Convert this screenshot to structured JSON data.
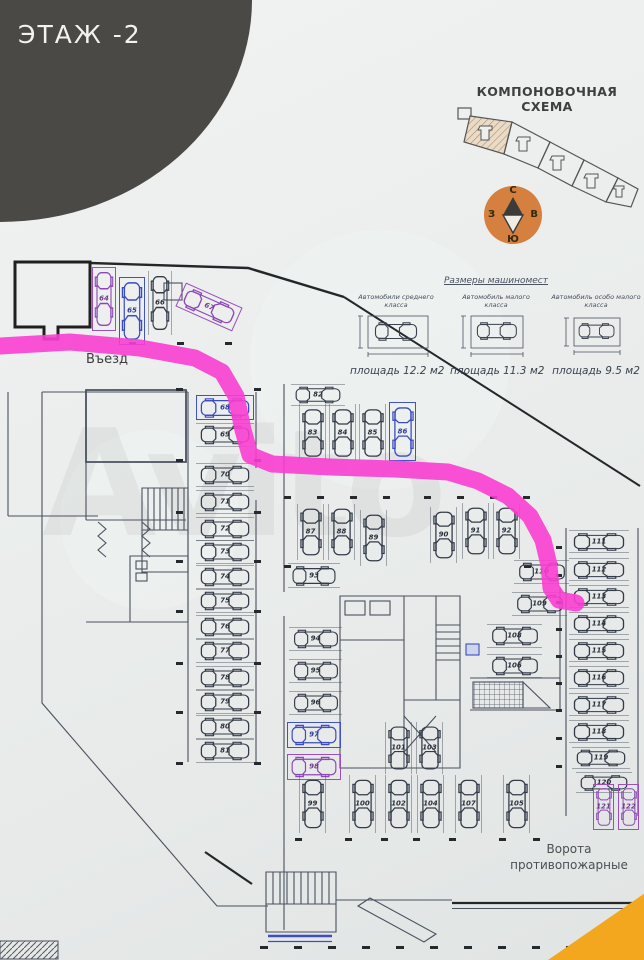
{
  "page": {
    "title": "ЭТАЖ -2",
    "background": "#e9ecea"
  },
  "scheme": {
    "title": "КОМПОНОВОЧНАЯ СХЕМА"
  },
  "compass": {
    "north": "С",
    "east": "В",
    "south": "Ю",
    "west": "З",
    "circle_color": "#d5803e"
  },
  "sizes": {
    "title": "Размеры машиномест",
    "items": [
      {
        "car_class": "Автомобили среднего класса",
        "area": "площадь 12.2 м2"
      },
      {
        "car_class": "Автомобиль малого класса",
        "area": "площадь 11.3 м2"
      },
      {
        "car_class": "Автомобиль особо малого класса",
        "area": "площадь 9.5 м2"
      }
    ]
  },
  "plan": {
    "entrance_label": "Въезд",
    "gates_label": "Ворота противопожарные",
    "route_color": "#fa3ed2",
    "highlight_blue": "#4152c2",
    "highlight_purple": "#9a4fc0",
    "route_points": [
      [
        0,
        346
      ],
      [
        70,
        342
      ],
      [
        140,
        348
      ],
      [
        195,
        358
      ],
      [
        222,
        372
      ],
      [
        236,
        396
      ],
      [
        243,
        430
      ],
      [
        250,
        455
      ],
      [
        272,
        464
      ],
      [
        330,
        467
      ],
      [
        395,
        469
      ],
      [
        448,
        472
      ],
      [
        478,
        481
      ],
      [
        508,
        496
      ],
      [
        530,
        516
      ],
      [
        543,
        540
      ],
      [
        549,
        565
      ],
      [
        551,
        588
      ],
      [
        559,
        600
      ],
      [
        576,
        603
      ]
    ],
    "stalls": [
      {
        "n": "64",
        "x": 92,
        "y": 267,
        "w": 24,
        "h": 64,
        "o": "v",
        "hl": "purple"
      },
      {
        "n": "65",
        "x": 119,
        "y": 277,
        "w": 26,
        "h": 68,
        "o": "v",
        "hl": "blue"
      },
      {
        "n": "66",
        "x": 148,
        "y": 271,
        "w": 24,
        "h": 64,
        "o": "v"
      },
      {
        "n": "67",
        "x": 178,
        "y": 294,
        "w": 62,
        "h": 26,
        "o": "h",
        "hl": "purple",
        "a": 24
      },
      {
        "n": "68",
        "x": 196,
        "y": 395,
        "w": 58,
        "h": 25,
        "o": "h",
        "hl": "blue"
      },
      {
        "n": "69",
        "x": 196,
        "y": 423,
        "w": 58,
        "h": 24,
        "o": "h"
      },
      {
        "n": "70",
        "x": 196,
        "y": 463,
        "w": 58,
        "h": 24,
        "o": "h"
      },
      {
        "n": "71",
        "x": 196,
        "y": 490,
        "w": 58,
        "h": 24,
        "o": "h"
      },
      {
        "n": "72",
        "x": 196,
        "y": 517,
        "w": 58,
        "h": 24,
        "o": "h"
      },
      {
        "n": "73",
        "x": 196,
        "y": 540,
        "w": 58,
        "h": 24,
        "o": "h"
      },
      {
        "n": "74",
        "x": 196,
        "y": 565,
        "w": 58,
        "h": 24,
        "o": "h"
      },
      {
        "n": "75",
        "x": 196,
        "y": 589,
        "w": 58,
        "h": 24,
        "o": "h"
      },
      {
        "n": "76",
        "x": 196,
        "y": 615,
        "w": 58,
        "h": 24,
        "o": "h"
      },
      {
        "n": "77",
        "x": 196,
        "y": 639,
        "w": 58,
        "h": 24,
        "o": "h"
      },
      {
        "n": "78",
        "x": 196,
        "y": 666,
        "w": 58,
        "h": 24,
        "o": "h"
      },
      {
        "n": "79",
        "x": 196,
        "y": 690,
        "w": 58,
        "h": 24,
        "o": "h"
      },
      {
        "n": "80",
        "x": 196,
        "y": 715,
        "w": 58,
        "h": 24,
        "o": "h"
      },
      {
        "n": "81",
        "x": 196,
        "y": 739,
        "w": 58,
        "h": 24,
        "o": "h"
      },
      {
        "n": "82",
        "x": 291,
        "y": 384,
        "w": 54,
        "h": 22,
        "o": "h"
      },
      {
        "n": "83",
        "x": 299,
        "y": 404,
        "w": 27,
        "h": 57,
        "o": "v"
      },
      {
        "n": "84",
        "x": 329,
        "y": 404,
        "w": 27,
        "h": 57,
        "o": "v"
      },
      {
        "n": "85",
        "x": 359,
        "y": 404,
        "w": 27,
        "h": 57,
        "o": "v"
      },
      {
        "n": "86",
        "x": 389,
        "y": 402,
        "w": 27,
        "h": 59,
        "o": "v",
        "hl": "blue"
      },
      {
        "n": "87",
        "x": 297,
        "y": 504,
        "w": 27,
        "h": 56,
        "o": "v"
      },
      {
        "n": "88",
        "x": 328,
        "y": 504,
        "w": 27,
        "h": 56,
        "o": "v"
      },
      {
        "n": "89",
        "x": 360,
        "y": 510,
        "w": 27,
        "h": 56,
        "o": "v"
      },
      {
        "n": "90",
        "x": 430,
        "y": 507,
        "w": 27,
        "h": 56,
        "o": "v"
      },
      {
        "n": "91",
        "x": 462,
        "y": 503,
        "w": 27,
        "h": 56,
        "o": "v"
      },
      {
        "n": "92",
        "x": 493,
        "y": 503,
        "w": 27,
        "h": 56,
        "o": "v"
      },
      {
        "n": "93",
        "x": 288,
        "y": 563,
        "w": 52,
        "h": 25,
        "o": "h"
      },
      {
        "n": "94",
        "x": 289,
        "y": 627,
        "w": 53,
        "h": 24,
        "o": "h"
      },
      {
        "n": "95",
        "x": 289,
        "y": 659,
        "w": 53,
        "h": 24,
        "o": "h"
      },
      {
        "n": "96",
        "x": 289,
        "y": 691,
        "w": 53,
        "h": 24,
        "o": "h"
      },
      {
        "n": "97",
        "x": 287,
        "y": 722,
        "w": 54,
        "h": 26,
        "o": "h",
        "hl": "blue"
      },
      {
        "n": "98",
        "x": 287,
        "y": 754,
        "w": 54,
        "h": 26,
        "o": "h",
        "hl": "purple"
      },
      {
        "n": "99",
        "x": 299,
        "y": 775,
        "w": 27,
        "h": 58,
        "o": "v"
      },
      {
        "n": "100",
        "x": 349,
        "y": 775,
        "w": 27,
        "h": 58,
        "o": "v"
      },
      {
        "n": "101",
        "x": 385,
        "y": 722,
        "w": 27,
        "h": 52,
        "o": "v"
      },
      {
        "n": "102",
        "x": 385,
        "y": 775,
        "w": 27,
        "h": 58,
        "o": "v"
      },
      {
        "n": "103",
        "x": 416,
        "y": 722,
        "w": 27,
        "h": 52,
        "o": "v"
      },
      {
        "n": "104",
        "x": 417,
        "y": 775,
        "w": 27,
        "h": 58,
        "o": "v"
      },
      {
        "n": "107",
        "x": 455,
        "y": 775,
        "w": 27,
        "h": 58,
        "o": "v"
      },
      {
        "n": "105",
        "x": 503,
        "y": 775,
        "w": 27,
        "h": 58,
        "o": "v"
      },
      {
        "n": "106",
        "x": 487,
        "y": 654,
        "w": 55,
        "h": 24,
        "o": "h"
      },
      {
        "n": "108",
        "x": 487,
        "y": 624,
        "w": 55,
        "h": 24,
        "o": "h"
      },
      {
        "n": "109",
        "x": 512,
        "y": 592,
        "w": 55,
        "h": 24,
        "o": "h"
      },
      {
        "n": "110",
        "x": 514,
        "y": 560,
        "w": 55,
        "h": 24,
        "o": "h"
      },
      {
        "n": "111",
        "x": 569,
        "y": 530,
        "w": 60,
        "h": 23,
        "o": "h"
      },
      {
        "n": "112",
        "x": 569,
        "y": 558,
        "w": 60,
        "h": 23,
        "o": "h"
      },
      {
        "n": "113",
        "x": 569,
        "y": 585,
        "w": 60,
        "h": 23,
        "o": "h"
      },
      {
        "n": "114",
        "x": 569,
        "y": 612,
        "w": 60,
        "h": 23,
        "o": "h"
      },
      {
        "n": "115",
        "x": 569,
        "y": 639,
        "w": 60,
        "h": 23,
        "o": "h"
      },
      {
        "n": "116",
        "x": 569,
        "y": 666,
        "w": 60,
        "h": 23,
        "o": "h"
      },
      {
        "n": "117",
        "x": 569,
        "y": 693,
        "w": 60,
        "h": 23,
        "o": "h"
      },
      {
        "n": "118",
        "x": 569,
        "y": 720,
        "w": 60,
        "h": 23,
        "o": "h"
      },
      {
        "n": "119",
        "x": 572,
        "y": 747,
        "w": 58,
        "h": 22,
        "o": "h"
      },
      {
        "n": "120",
        "x": 576,
        "y": 772,
        "w": 56,
        "h": 21,
        "o": "h"
      },
      {
        "n": "121",
        "x": 593,
        "y": 784,
        "w": 21,
        "h": 46,
        "o": "v",
        "hl": "purple"
      },
      {
        "n": "122",
        "x": 618,
        "y": 784,
        "w": 21,
        "h": 46,
        "o": "v",
        "hl": "purple"
      }
    ]
  },
  "watermark": "Avito"
}
